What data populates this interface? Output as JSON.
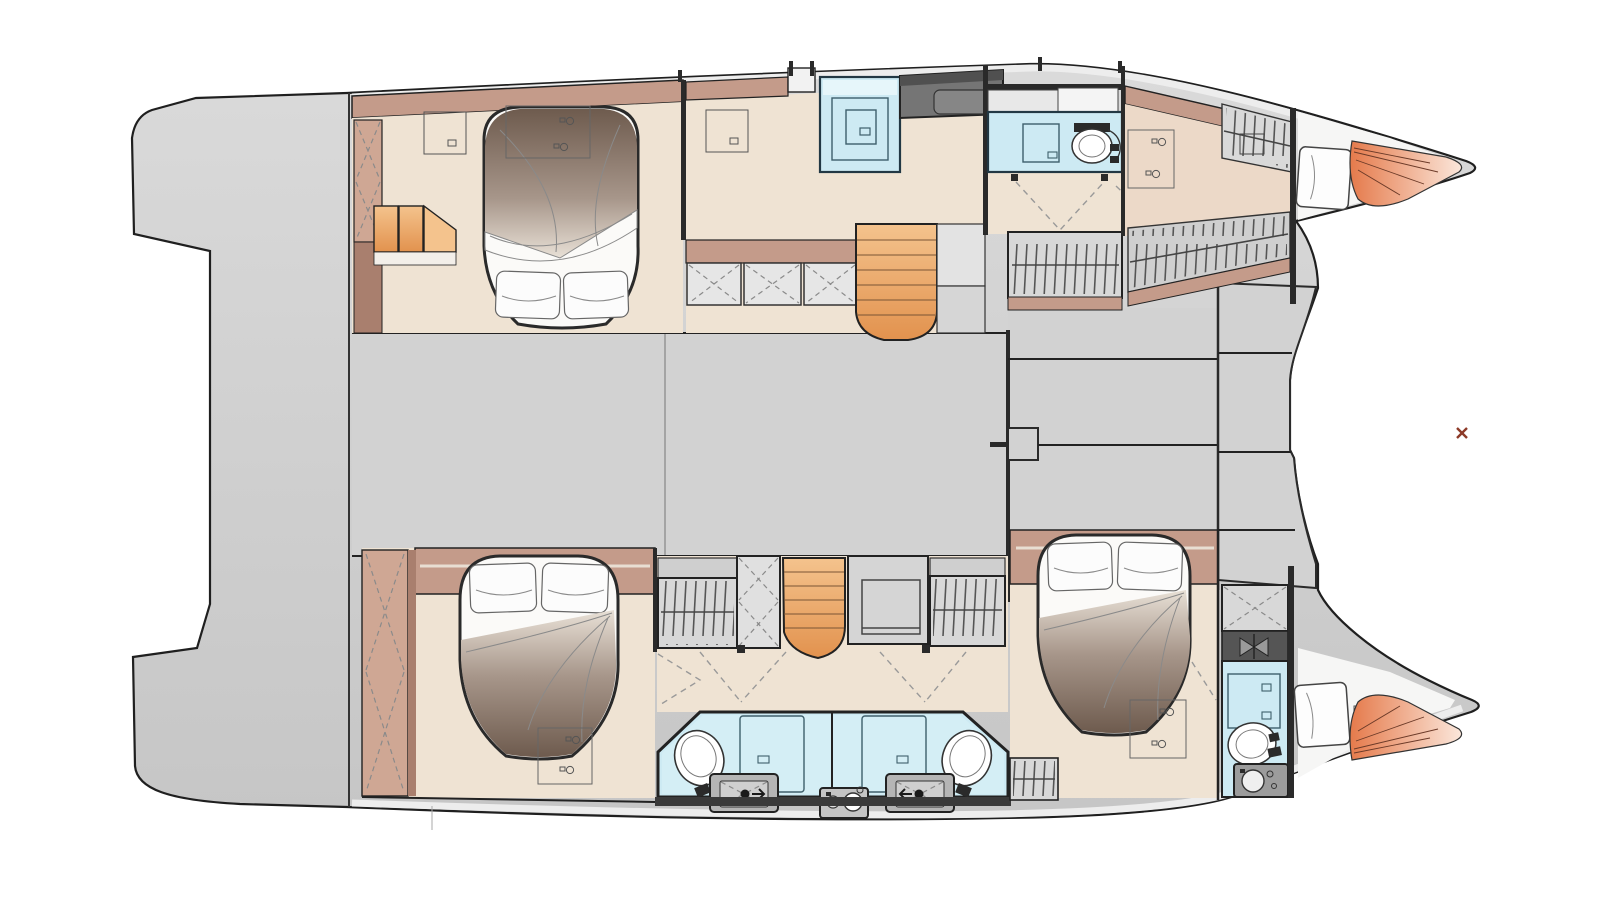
{
  "meta": {
    "diagram_kind": "catamaran interior floor plan, overhead view",
    "bow_direction": "right",
    "visible_text": ""
  },
  "colors": {
    "page_bg": "#ffffff",
    "hull_outline": "#1f1f1f",
    "deck_top": "#dadada",
    "deck_bottom": "#c6c6c6",
    "salon_gray": "#d2d2d2",
    "deck_white": "#ededed",
    "floor_beige": "#efe3d3",
    "floor_tan": "#ecd9c8",
    "wall_mauve": "#c49b8a",
    "wall_mauve_dark": "#a97f6e",
    "wardrobe_mauve": "#cfa794",
    "trim_dark": "#2a2a2a",
    "counter_gray": "#757575",
    "counter_gray_dark": "#505050",
    "cushion_gray": "#e6e6e6",
    "locker_gray": "#dedede",
    "locker_slash": "#555555",
    "stairs_light": "#f4c38d",
    "stairs_dark": "#e2924e",
    "bath_blue": "#cdeaf3",
    "bath_blue_light": "#e6f6fa",
    "glass_stroke": "#3e5f6b",
    "bed_white": "#fbfaf8",
    "duvet_dark": "#6e5b4e",
    "duvet_mid": "#a7968a",
    "duvet_light": "#e8e0d6",
    "sketch_gray": "#8a8a8a",
    "cone_dark": "#e57a4b",
    "cone_light": "#fbe7db",
    "marker_red": "#8d3a28"
  },
  "layout": {
    "vessel": "catamaran",
    "view": "single deck plan, both hulls plus bridgedeck",
    "hulls": [
      {
        "side": "top",
        "spaces": [
          "aft-double-cabin",
          "companionway-shower",
          "galley-counter",
          "forward-bathroom",
          "forward-cabin",
          "bow-crew-berth"
        ]
      },
      {
        "side": "bottom",
        "spaces": [
          "aft-double-cabin",
          "dressing-stairs-desk",
          "twin-aft-bathrooms",
          "forward-double-cabin",
          "forward-bathroom",
          "bow-crew-berth"
        ]
      }
    ],
    "bridgedeck": [
      "saloon-floor",
      "foredeck-steps",
      "aft-platform"
    ],
    "fixtures": {
      "double_beds": 3,
      "bow_berths": 2,
      "toilets": 4,
      "shower_enclosures": 5,
      "staircases": 2,
      "hanging_lockers": 6,
      "mirrored_cabinets": 3,
      "vanity_sinks": 3,
      "deck_hatches": 2
    }
  }
}
